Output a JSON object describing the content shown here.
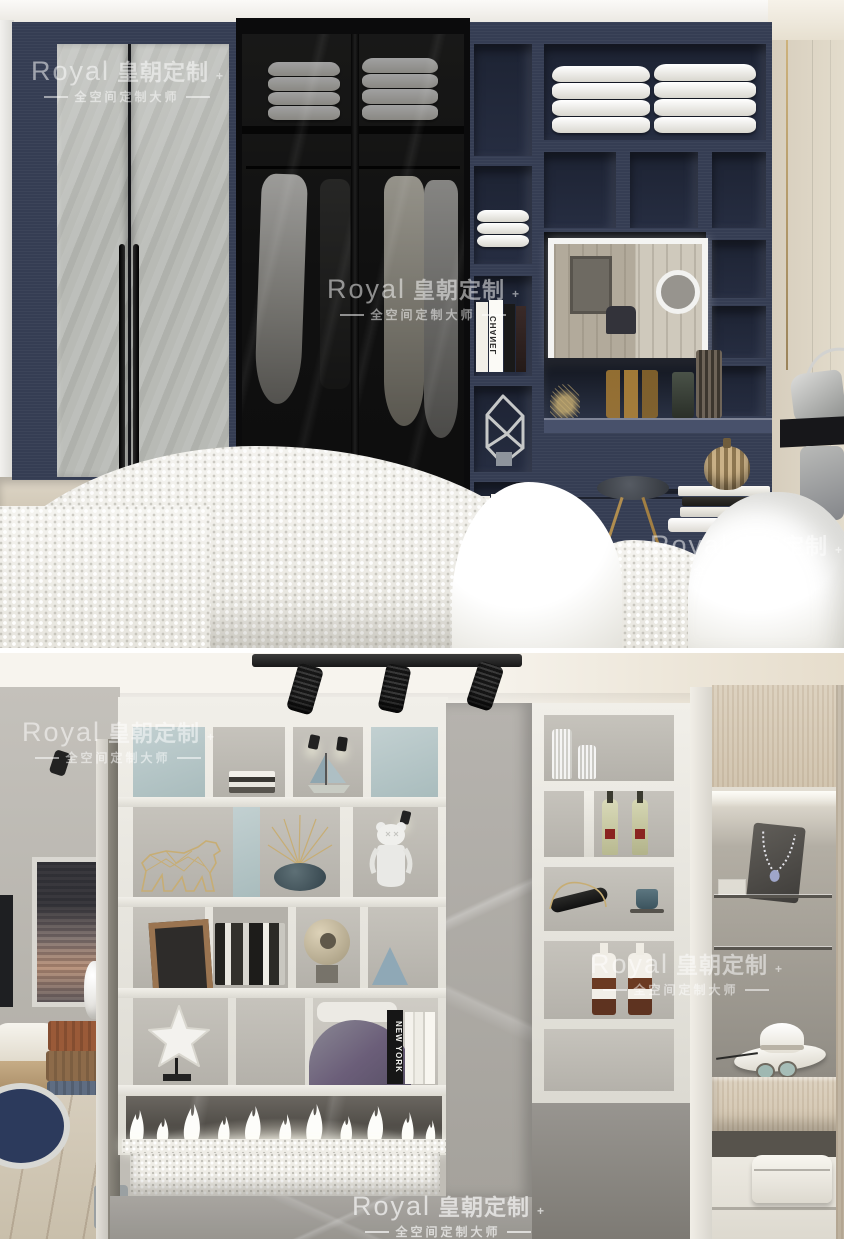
{
  "brand": {
    "logo": "Royal",
    "wordmark": "皇朝定制",
    "plus": "+",
    "tagline": "全空间定制大师"
  },
  "book_spines": {
    "chanel": "CHANEL",
    "new_york": "NEW YORK"
  },
  "palette": {
    "navy_cabinet": "#353d53",
    "black_glass_door": "#141414",
    "marble_door_gray": "#b6b8b3",
    "cream_wall": "#ddd5c5",
    "sage_shelf_back": "#b5c6c7",
    "shelf_frame_white": "#ebe9e3",
    "gray_marble_panel": "#b0ada8",
    "oak_cabinet": "#d8ccb9",
    "flame_white": "#fdfdfa",
    "gold_wire": "#c7ad74"
  }
}
